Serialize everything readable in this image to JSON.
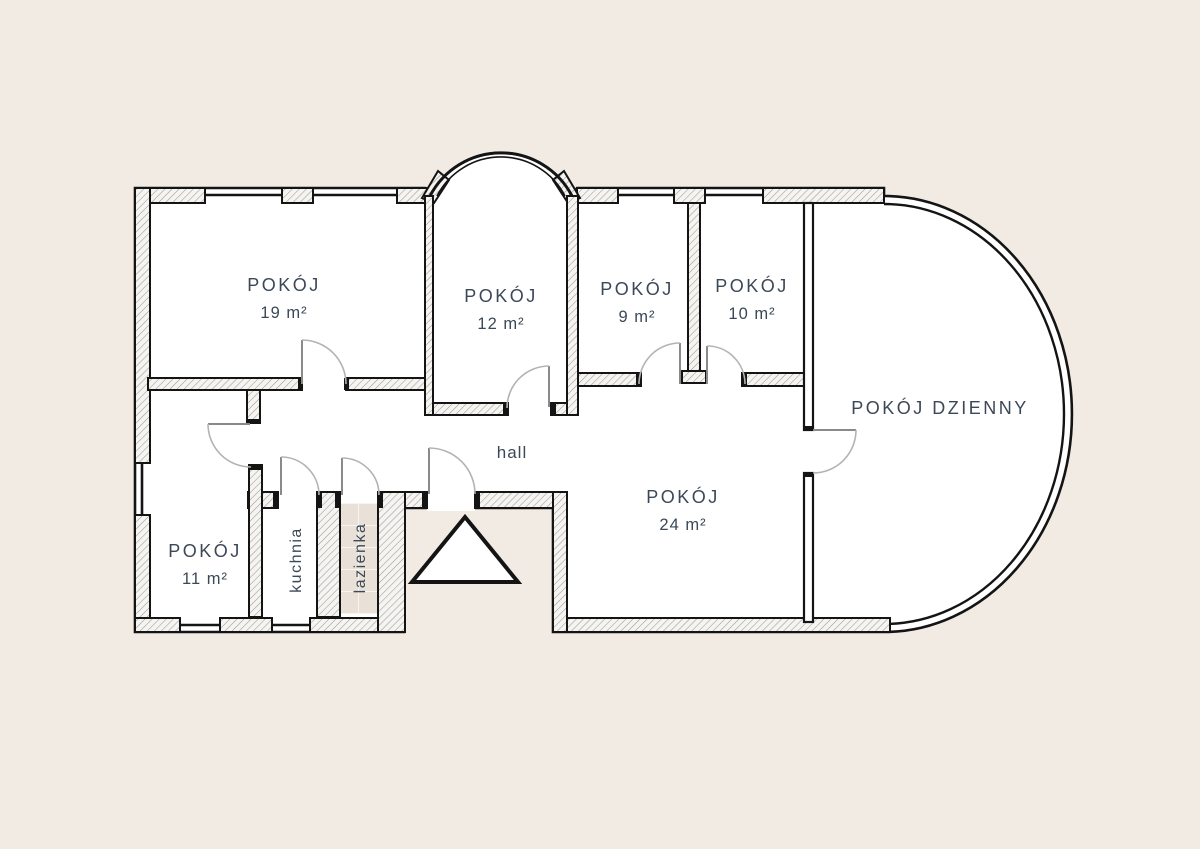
{
  "plan": {
    "type": "apartment-floor-plan",
    "rooms": {
      "pokoj19": {
        "name": "POKÓJ",
        "area": "19 m²"
      },
      "pokoj12": {
        "name": "POKÓJ",
        "area": "12 m²"
      },
      "pokoj9": {
        "name": "POKÓJ",
        "area": "9 m²"
      },
      "pokoj10": {
        "name": "POKÓJ",
        "area": "10 m²"
      },
      "dzienny": {
        "name": "POKÓJ DZIENNY"
      },
      "pokoj24": {
        "name": "POKÓJ",
        "area": "24 m²"
      },
      "pokoj11": {
        "name": "POKÓJ",
        "area": "11 m²"
      },
      "hall": {
        "name": "hall"
      },
      "kuchnia": {
        "name": "kuchnia"
      },
      "lazienka": {
        "name": "lazienka"
      }
    },
    "icons": {
      "entrance_marker": "triangle-up"
    },
    "colors": {
      "background": "#f1ebe4",
      "interior": "#ffffff",
      "wall_line": "#141414",
      "label": "#3b4858",
      "tile": "#e9e1d7",
      "tile_grout": "#f8f5ef",
      "door_arc": "#b3b3b3",
      "door_leaf": "#8a8a8a"
    }
  }
}
